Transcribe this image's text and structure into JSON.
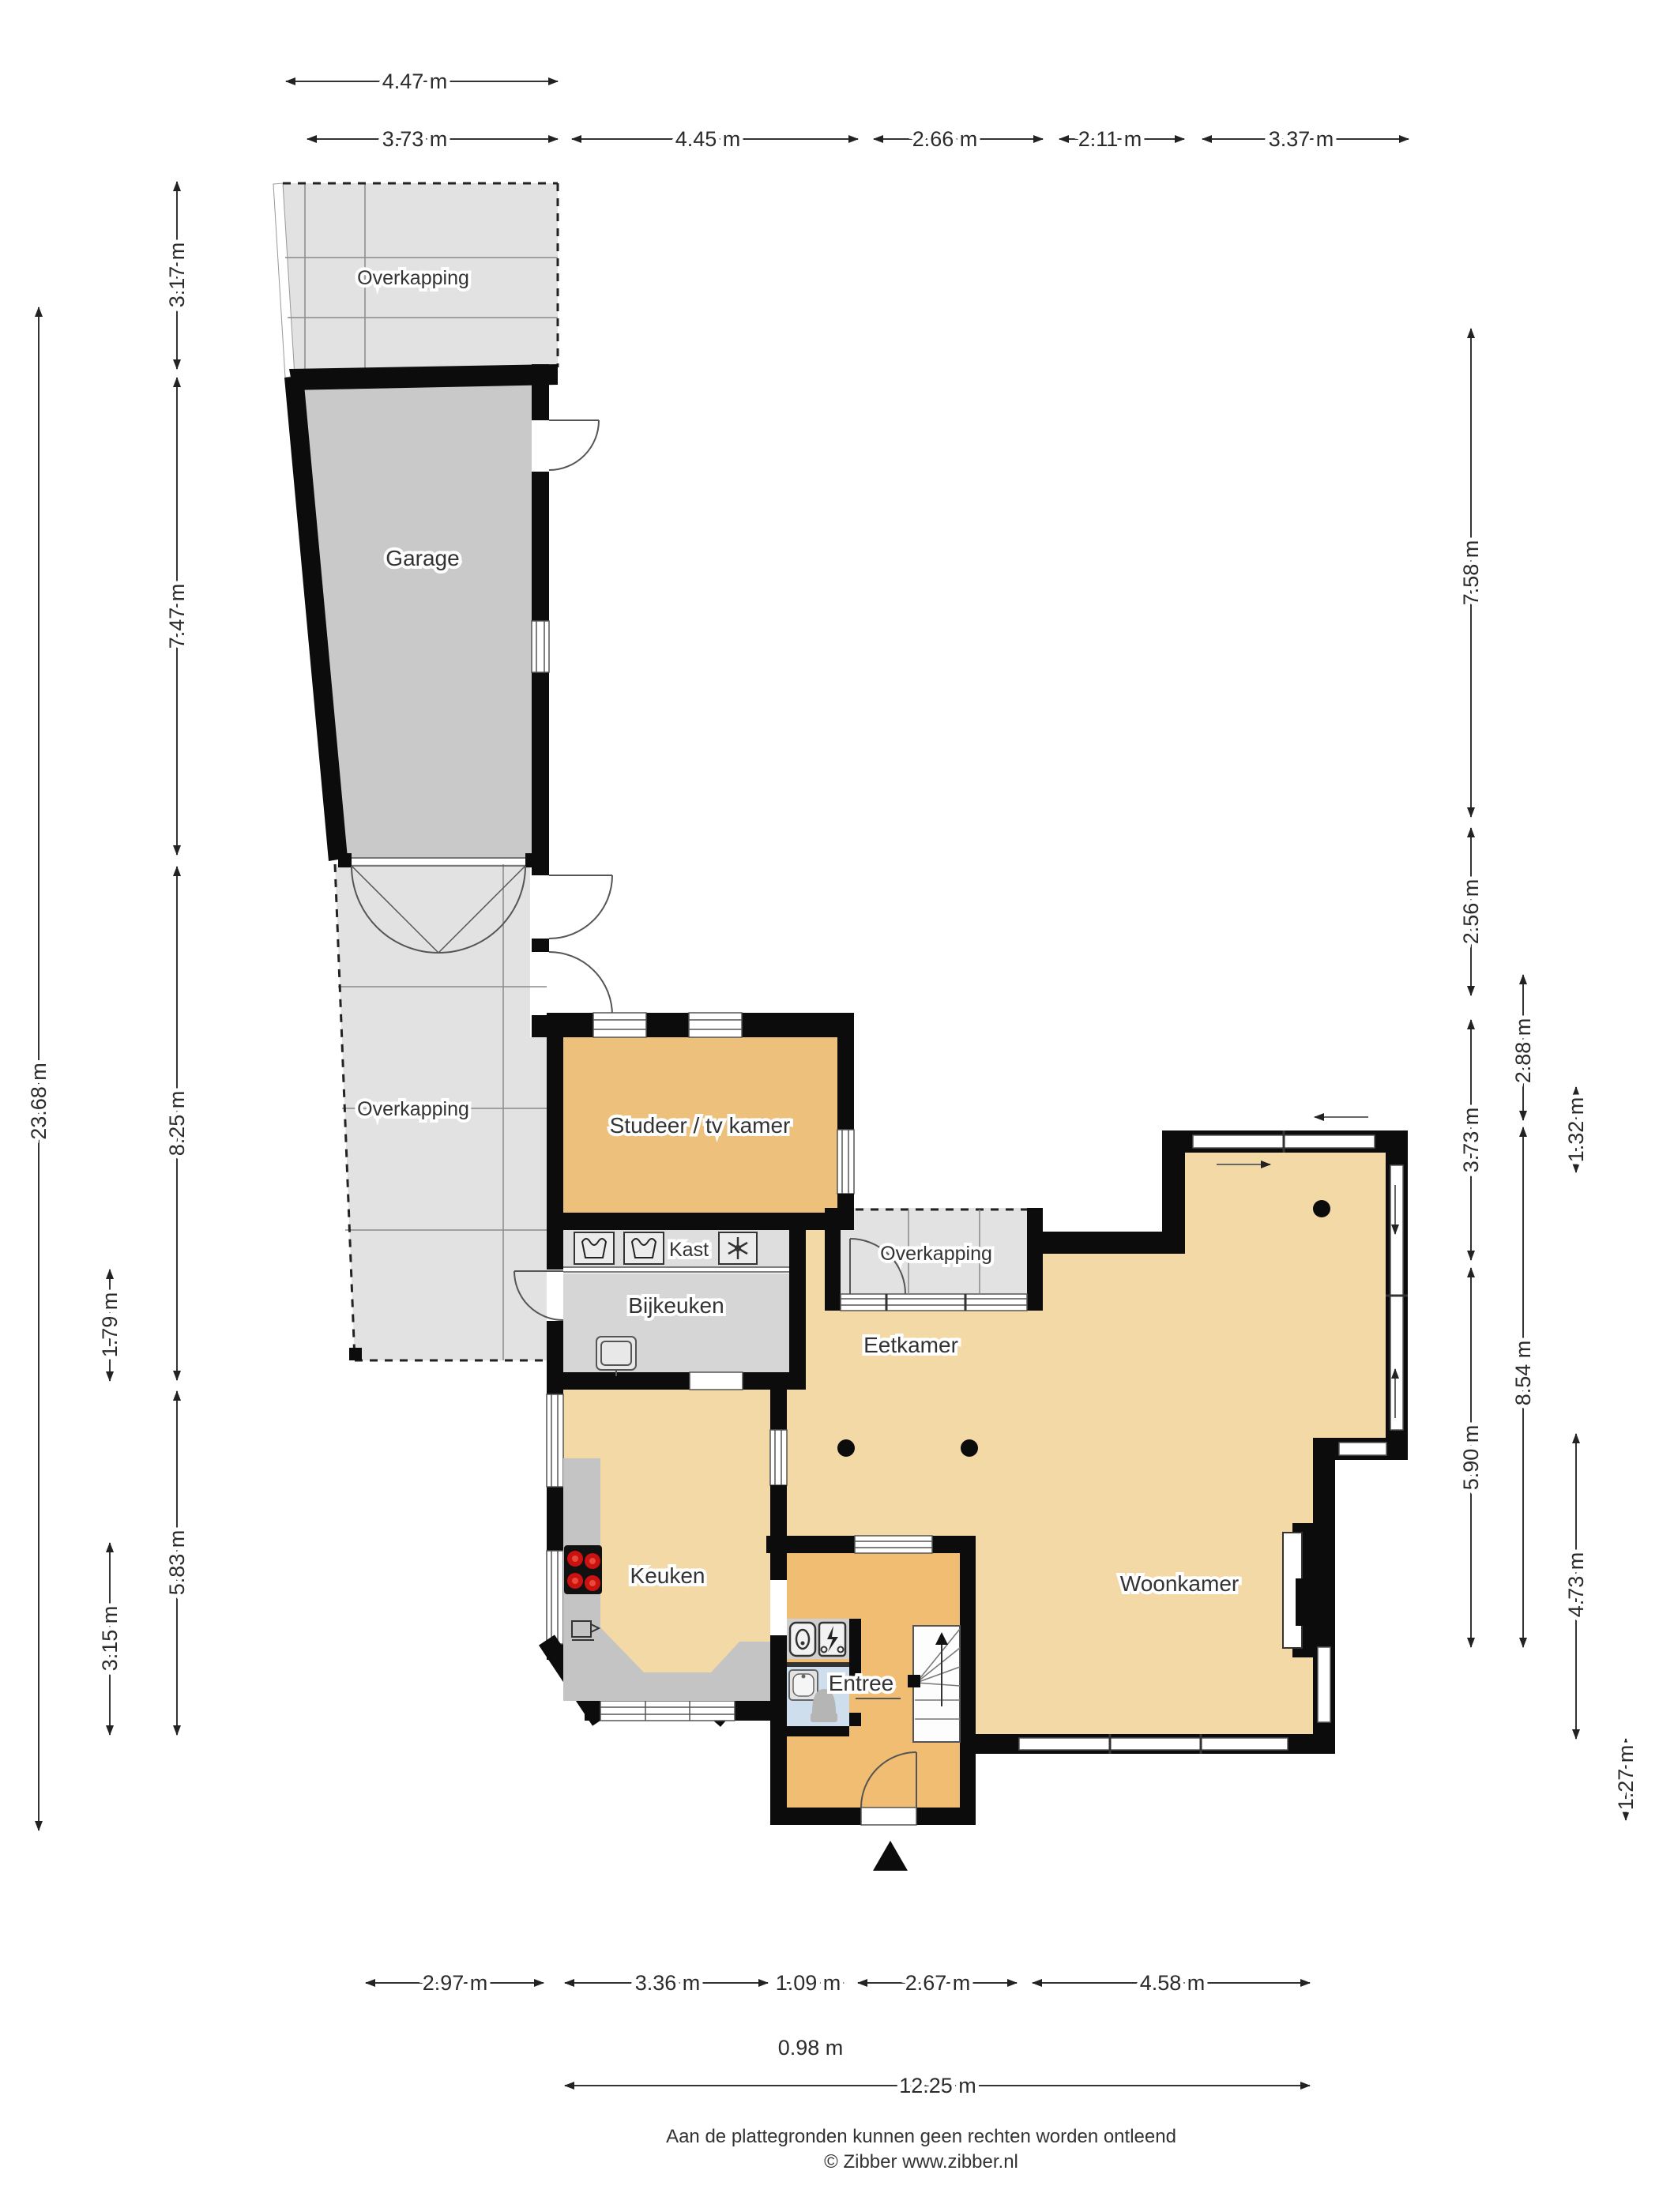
{
  "title": "Begane grond plattegrond",
  "rooms": [
    {
      "id": "overkapping-top",
      "label": "Overkapping"
    },
    {
      "id": "garage",
      "label": "Garage"
    },
    {
      "id": "overkapping-left",
      "label": "Overkapping"
    },
    {
      "id": "studeer",
      "label": "Studeer / tv kamer"
    },
    {
      "id": "kast",
      "label": "Kast"
    },
    {
      "id": "bijkeuken",
      "label": "Bijkeuken"
    },
    {
      "id": "overkapping-small",
      "label": "Overkapping"
    },
    {
      "id": "eetkamer",
      "label": "Eetkamer"
    },
    {
      "id": "keuken",
      "label": "Keuken"
    },
    {
      "id": "woonkamer",
      "label": "Woonkamer"
    },
    {
      "id": "entree",
      "label": "Entree"
    }
  ],
  "dimensions": {
    "top": [
      {
        "label": "4.47 m"
      },
      {
        "label": "3.73 m"
      },
      {
        "label": "4.45 m"
      },
      {
        "label": "2.66 m"
      },
      {
        "label": "2.11 m"
      },
      {
        "label": "3.37 m"
      }
    ],
    "left": [
      {
        "label": "23.68 m"
      },
      {
        "label": "3.17 m"
      },
      {
        "label": "7.47 m"
      },
      {
        "label": "8.25 m"
      },
      {
        "label": "1.79 m"
      },
      {
        "label": "5.83 m"
      },
      {
        "label": "3.15 m"
      }
    ],
    "right": [
      {
        "label": "7.58 m"
      },
      {
        "label": "2.56 m"
      },
      {
        "label": "3.73 m"
      },
      {
        "label": "5.90 m"
      },
      {
        "label": "2.88 m"
      },
      {
        "label": "8.54 m"
      },
      {
        "label": "1.32 m"
      },
      {
        "label": "4.73 m"
      },
      {
        "label": "1.27 m"
      }
    ],
    "bottom": [
      {
        "label": "2.97 m"
      },
      {
        "label": "3.36 m"
      },
      {
        "label": "1.09 m"
      },
      {
        "label": "2.67 m"
      },
      {
        "label": "4.58 m"
      },
      {
        "label": "0.98 m"
      },
      {
        "label": "12.25 m"
      }
    ]
  },
  "footer": {
    "line1": "Aan de plattegronden kunnen geen rechten worden ontleend",
    "line2": "© Zibber www.zibber.nl"
  },
  "icons": {
    "kast": [
      "washing-machine-icon",
      "washing-machine-icon",
      "ventilation-fan-icon"
    ],
    "technical": [
      "boiler-icon",
      "electric-meter-icon"
    ],
    "keuken": [
      "cooktop-icon",
      "coffee-machine-icon"
    ],
    "toilet": [
      "corner-sink-icon",
      "toilet-icon"
    ],
    "other": [
      "ceiling-light-icon",
      "stairs-up-arrow-icon",
      "entrance-triangle-icon"
    ]
  },
  "colors": {
    "wall": "#0c0c0c",
    "room_orange": "#edc07c",
    "room_beige": "#f3d9a6",
    "entree_orange": "#f0bd72",
    "garage_gray": "#c9c9c9",
    "overkapping_gray": "#e2e2e2",
    "utility_gray": "#d6d6d6",
    "counter_gray": "#c4c4c4",
    "toilet_blue": "#cfdeed",
    "burner_red": "#cc1111",
    "dim_text": "#2b2b2b"
  }
}
